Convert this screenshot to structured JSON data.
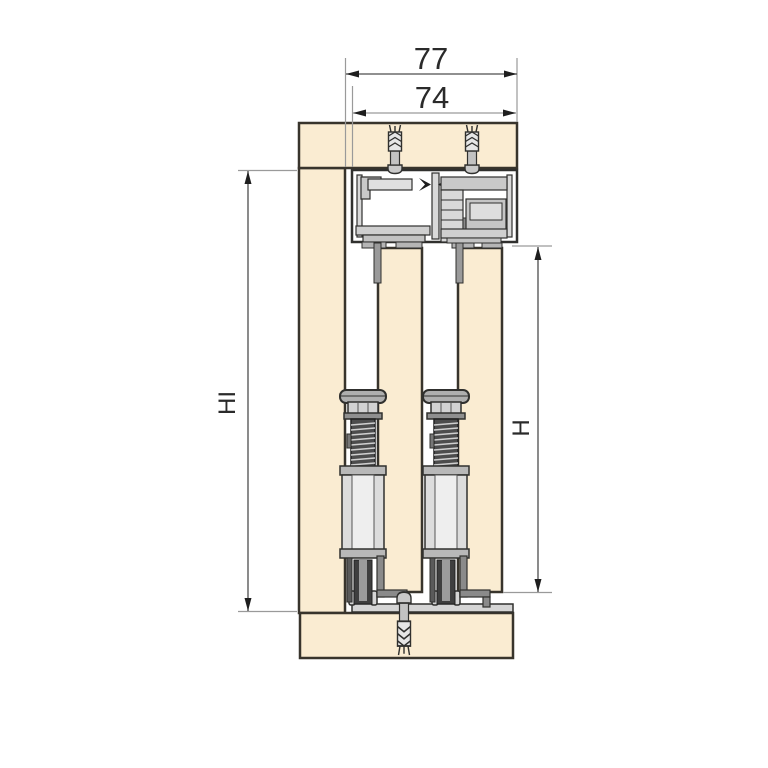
{
  "diagram": {
    "kind": "sliding-door-system-vertical-cross-section",
    "background": "#FFFFFF"
  },
  "dimensions": {
    "overall_width": {
      "value": "77"
    },
    "inner_width": {
      "value": "74"
    },
    "interior_height": {
      "value": "HI"
    },
    "door_height": {
      "value": "H"
    }
  },
  "colors": {
    "wood": "#FAECD2",
    "wood_outline": "#38342C",
    "metal_light": "#DCDCDC",
    "metal_mid": "#C5C5C5",
    "metal_dark": "#4C4C4C",
    "outline": "#30302E",
    "dim_line": "#4D4D4D",
    "dim_line_light": "#ABABAB",
    "ext_line": "#9A9A9A",
    "text": "#2A2A2A"
  },
  "parts": [
    "top-panel",
    "left-side-panel",
    "bottom-panel",
    "top-rail-profile",
    "roller-carriage",
    "left-door-panel",
    "right-door-panel",
    "left-bottom-guide",
    "right-bottom-guide",
    "bottom-rail-profile",
    "wall-plug-top-left",
    "wall-plug-top-right",
    "wall-plug-bottom"
  ]
}
